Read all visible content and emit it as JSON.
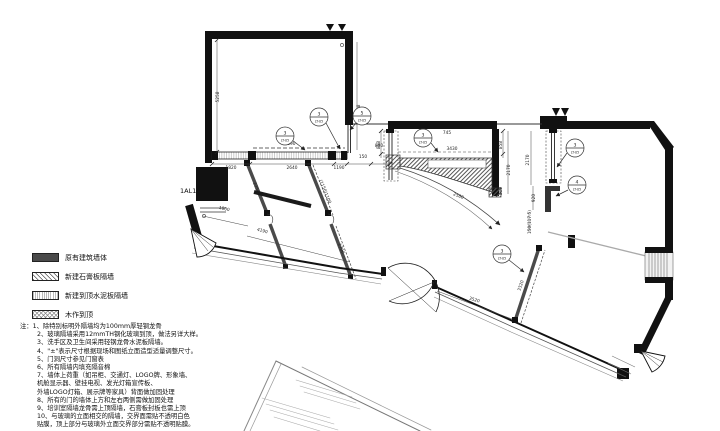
{
  "colors": {
    "wall": "#111111",
    "partition": "#4a4a4a",
    "gray_line": "#aaaaaa",
    "paper": "#ffffff"
  },
  "plan": {
    "area_label": "1AL1",
    "callouts": [
      {
        "num": "3",
        "sheet": "LT-05"
      },
      {
        "num": "3",
        "sheet": "LT-05"
      },
      {
        "num": "5",
        "sheet": "LT-05"
      },
      {
        "num": "3",
        "sheet": "LT-05"
      },
      {
        "num": "3",
        "sheet": "LT-05"
      },
      {
        "num": "4",
        "sheet": "LT-05"
      },
      {
        "num": "3",
        "sheet": "LT-05"
      }
    ],
    "dims": {
      "v_left": "5258",
      "top_dashed": "6890",
      "seg1": "1820",
      "seg2": "2640",
      "seg3": "1190",
      "seg4": "880",
      "seg5": "150",
      "v_right": "3608",
      "mid_width": "3430",
      "mid_h1": "858",
      "mid_h2": "858",
      "mid_v1": "2170",
      "mid_v2": "2170",
      "mid_small": "745",
      "mid_800": "800",
      "mid_920": "920",
      "mid_117": "150(117.5)",
      "arc_r": "2580",
      "wall_3320": "3320",
      "door_3520": "3520",
      "tr_1800": "1800",
      "tr_2250": "2250",
      "tr_4190": "4190",
      "tr_1700": "1700",
      "tr_1150": "(1150)1100"
    }
  },
  "legend": {
    "items": [
      {
        "label": "原有建筑墙体",
        "pattern": "solid-dark"
      },
      {
        "label": "新建石膏板隔墙",
        "pattern": "diagonal-hatch"
      },
      {
        "label": "新建到顶水泥板隔墙",
        "pattern": "fine-lines"
      },
      {
        "label": "木作到顶",
        "pattern": "cross-hatch"
      }
    ]
  },
  "notes": {
    "lines": [
      "注：1、除特别标明外隔墙均为100mm厚轻钢龙骨",
      "2、玻璃隔墙采用12mmTH钢化玻璃到顶，做法另详大样。",
      "3、洗手区及卫生间采用轻钢龙骨水泥板隔墙。",
      "4、\"±\"表示尺寸根据现场和图纸立面造型适量调整尺寸。",
      "5、门洞尺寸参见门窗表",
      "6、所有隔墙内填充隔音棉",
      "7、墙体上荷重（如吊柜、交通灯、LOGO牌、形象墙、",
      "机舱显示器、壁挂电视、发光灯箱宣传板、",
      "外墙LOGO灯箱、展示牌等家具）背面做加固处理",
      "8、所有的门的墙体上方和左右两侧需做加固处理",
      "9、培训室隔墙龙骨需上顶隔墙，石膏板封板也需上顶",
      "10、与玻璃的立面相交的隔墙，交界面需贴不透明白色",
      "贴膜，顶上部分与玻璃外立面交界部分需贴不透明贴膜。"
    ]
  }
}
